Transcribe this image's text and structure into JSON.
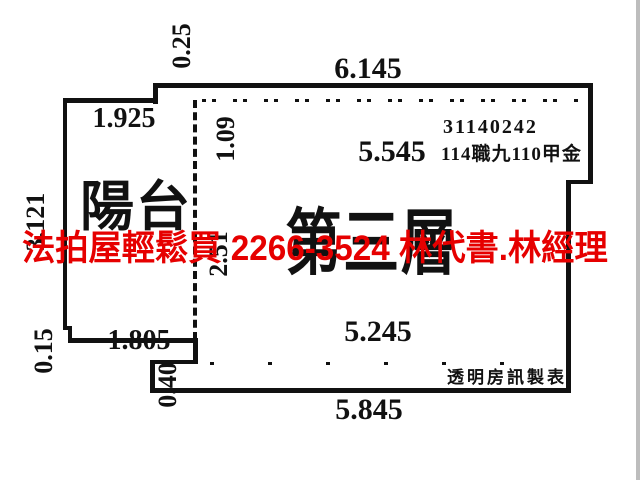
{
  "diagram": {
    "watermark": "法拍屋輕鬆買 2266-3524 林代書.林經理",
    "room_label": "第三層",
    "balcony_label": "陽台",
    "registration_no": "31140242",
    "registration_info": "114職九110甲金",
    "producer": "透明房訊製表",
    "dimensions": {
      "top_offset": "0.25",
      "top_width": "6.145",
      "balcony_top": "1.925",
      "top_inset": "1.09",
      "interior_width": "5.545",
      "balcony_left": "3.121",
      "divider": "2.51",
      "left_lower": "0.15",
      "balcony_bottom": "1.805",
      "bottom_step": "0.40",
      "interior_bottom": "5.245",
      "bottom_width": "5.845"
    },
    "colors": {
      "wall": "#111111",
      "watermark": "#e60000"
    }
  }
}
